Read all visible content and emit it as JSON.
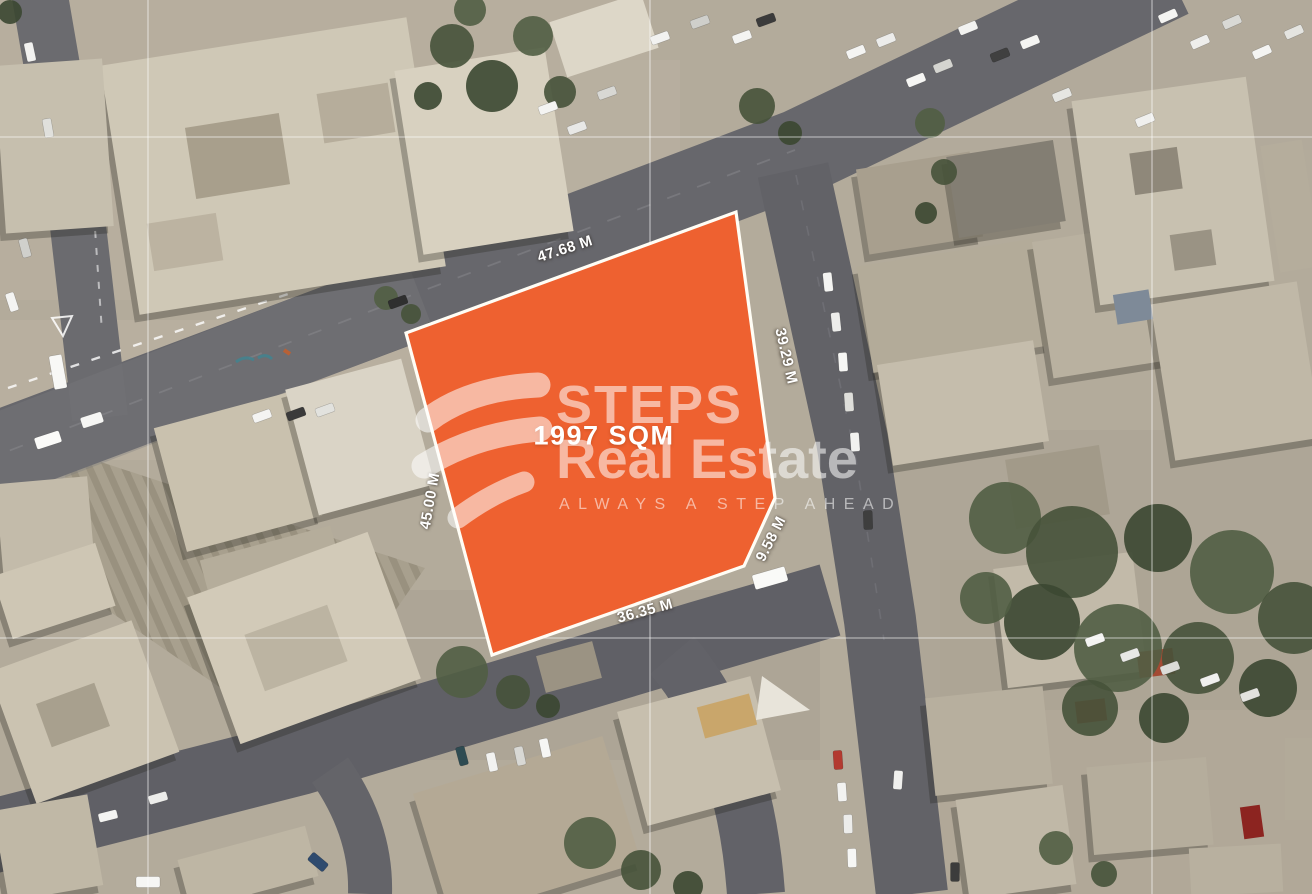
{
  "plot": {
    "area_label": "1997 SQM",
    "fill_color": "#EE6130",
    "outline_color": "#FFFDF5",
    "dimension_labels": {
      "top": "47.68 M",
      "right": "39.29 M",
      "corner": "9.58 M",
      "bottom": "36.35 M",
      "left": "45.00 M"
    }
  },
  "watermark": {
    "brand_line1": "STEPS",
    "brand_line2": "Real Estate",
    "tagline": "ALWAYS A STEP AHEAD",
    "logo_icon": "steps-swoosh-logo",
    "color": "#FFFFFF"
  }
}
